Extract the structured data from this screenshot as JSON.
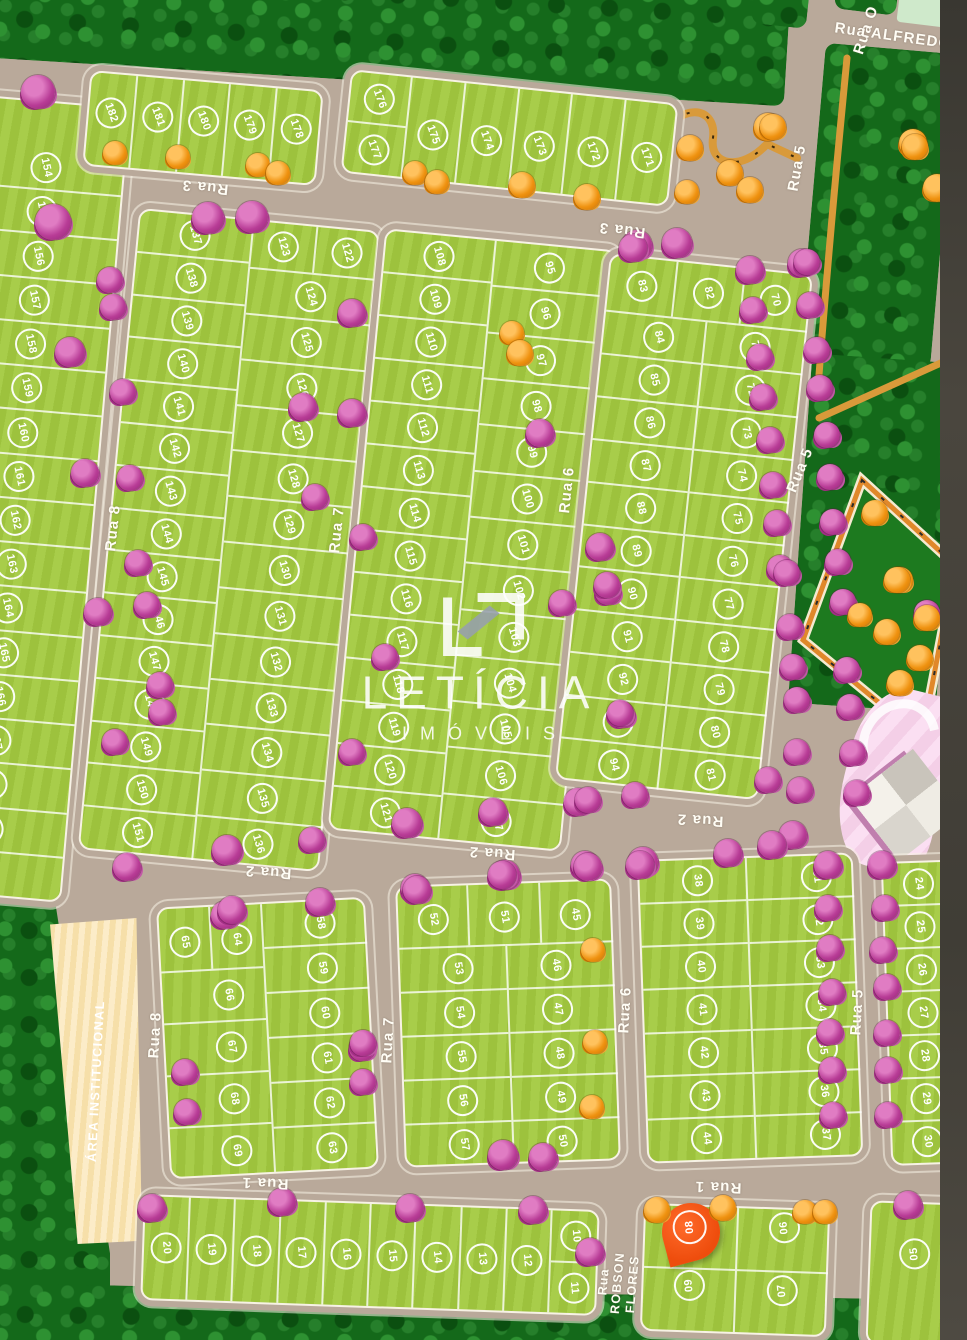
{
  "map": {
    "title": "Loteamento - mapa de lotes",
    "logo": {
      "name": "LETÍCIA",
      "subtitle": "IMÓVEIS"
    },
    "streets": [
      {
        "id": "rua-1",
        "name": "Rua 1"
      },
      {
        "id": "rua-2",
        "name": "Rua 2"
      },
      {
        "id": "rua-3",
        "name": "Rua 3"
      },
      {
        "id": "rua-5",
        "name": "Rua 5"
      },
      {
        "id": "rua-6",
        "name": "Rua 6"
      },
      {
        "id": "rua-7",
        "name": "Rua 7"
      },
      {
        "id": "rua-8",
        "name": "Rua 8"
      },
      {
        "id": "rua-o",
        "name": "Rua O"
      },
      {
        "id": "rua-alfredo",
        "name": "Rua ALFREDO"
      },
      {
        "id": "rua-robson-flores",
        "name": "Rua ROBSON FLORES"
      }
    ],
    "areas": [
      {
        "id": "area-institucional",
        "label": "ÁREA INSTITUCIONAL"
      }
    ],
    "highlight": {
      "lot": "08",
      "marker": "location-pin"
    },
    "blocks": {
      "leftStrip": [
        "154",
        "155",
        "156",
        "157",
        "158",
        "159",
        "160",
        "161",
        "162",
        "163",
        "164",
        "165",
        "166",
        "167",
        "168",
        "169",
        "170"
      ],
      "blockA": [
        "182",
        "181",
        "180",
        "179",
        "178"
      ],
      "blockB": {
        "stack": [
          "176",
          "177"
        ],
        "row": [
          "175",
          "174",
          "173",
          "172",
          "171"
        ]
      },
      "blockC": {
        "west": [
          "137",
          "138",
          "139",
          "140",
          "141",
          "142",
          "143",
          "144",
          "145",
          "146",
          "147",
          "148",
          "149",
          "150",
          "151"
        ],
        "eastTop": [
          "123",
          "122"
        ],
        "east": [
          "124",
          "125",
          "126",
          "127",
          "128",
          "129",
          "130",
          "131",
          "132",
          "133",
          "134",
          "135",
          "136"
        ]
      },
      "blockD": {
        "west": [
          "108",
          "109",
          "110",
          "111",
          "112",
          "113",
          "114",
          "115",
          "116",
          "117",
          "118",
          "119",
          "120",
          "121"
        ],
        "east": [
          "95",
          "96",
          "97",
          "98",
          "99",
          "100",
          "101",
          "102",
          "103",
          "104",
          "105",
          "106",
          "107"
        ]
      },
      "blockE": {
        "top": [
          "83",
          "82",
          "70"
        ],
        "west": [
          "84",
          "85",
          "86",
          "87",
          "88",
          "89",
          "90",
          "91",
          "92",
          "93",
          "94"
        ],
        "east": [
          "71",
          "72",
          "73",
          "74",
          "75",
          "76",
          "77",
          "78",
          "79",
          "80",
          "81"
        ]
      },
      "blockF": {
        "top": [
          "65",
          "64"
        ],
        "west": [
          "66",
          "67",
          "68",
          "69"
        ],
        "east": [
          "58",
          "59",
          "60",
          "61",
          "62",
          "63"
        ]
      },
      "blockG": {
        "top": [
          "52",
          "51",
          "45"
        ],
        "west": [
          "53",
          "54",
          "55",
          "56",
          "57"
        ],
        "east": [
          "46",
          "47",
          "48",
          "49",
          "50"
        ]
      },
      "blockH": {
        "west": [
          "38",
          "39",
          "40",
          "41",
          "42",
          "43",
          "44"
        ],
        "east": [
          "31",
          "32",
          "33",
          "34",
          "35",
          "36",
          "37"
        ]
      },
      "blockI": [
        "24",
        "25",
        "26",
        "27",
        "28",
        "29",
        "30"
      ],
      "bottomStrip": {
        "row": [
          "20",
          "19",
          "18",
          "17",
          "16",
          "15",
          "14",
          "13",
          "12"
        ],
        "pair": [
          "10",
          "11"
        ]
      },
      "blockRF": {
        "west": [
          "08",
          "09"
        ],
        "east": [
          "06",
          "07"
        ]
      },
      "block05": [
        "05"
      ]
    },
    "colors": {
      "road": "#b9a99a",
      "lot": "#a3ca3f",
      "forest": "#14691a",
      "treePink": "#c2479e",
      "treeOrange": "#f29a1f",
      "path": "#d99a3a",
      "pin": "#ee4d0d",
      "institutional": "#f6dfa9",
      "building": "#f4cfe7"
    }
  }
}
